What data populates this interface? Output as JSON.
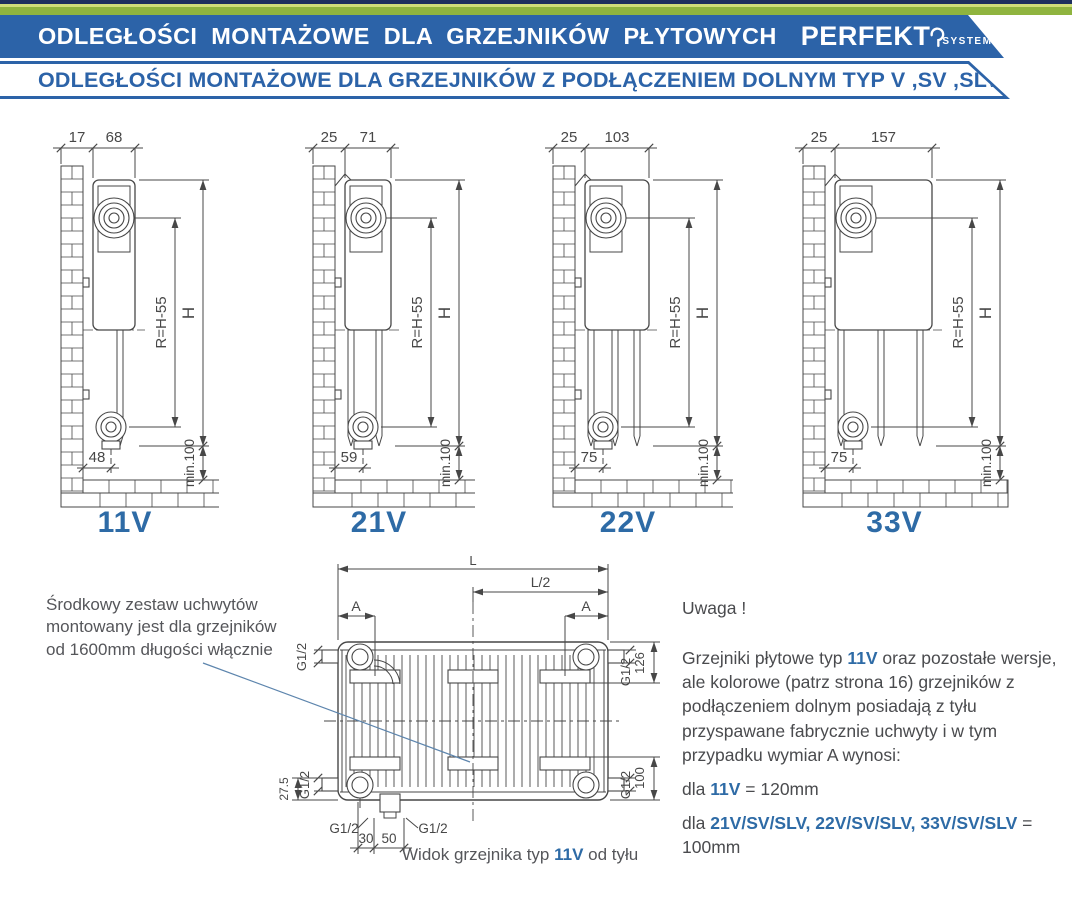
{
  "colors": {
    "ink": "#474747",
    "accent_blue": "#2e6ba6",
    "banner_blue": "#2c63a8",
    "navy": "#1d2f5e",
    "green": "#8fb43f",
    "green_light": "#cfdc7a",
    "leader": "#5d85ad",
    "text_gray": "#55565a"
  },
  "header": {
    "bar1_text": "ODLEGŁOŚCI MONTAŻOWE DLA GRZEJNIKÓW PŁYTOWYCH",
    "logo_main": "PERFEKT",
    "logo_sub": "SYSTEM",
    "bar2_text": "ODLEGŁOŚCI MONTAŻOWE DLA GRZEJNIKÓW Z PODŁĄCZENIEM DOLNYM TYP V ,SV ,SLV"
  },
  "diagrams": [
    {
      "label": "11V",
      "wall_offset": "17",
      "depth": "68",
      "bottom": "48",
      "r_dim": "R=H-55",
      "h_dim": "H",
      "min_dim": "min.100"
    },
    {
      "label": "21V",
      "wall_offset": "25",
      "depth": "71",
      "bottom": "59",
      "r_dim": "R=H-55",
      "h_dim": "H",
      "min_dim": "min.100"
    },
    {
      "label": "22V",
      "wall_offset": "25",
      "depth": "103",
      "bottom": "75",
      "r_dim": "R=H-55",
      "h_dim": "H",
      "min_dim": "min.100"
    },
    {
      "label": "33V",
      "wall_offset": "25",
      "depth": "157",
      "bottom": "75",
      "r_dim": "R=H-55",
      "h_dim": "H",
      "min_dim": "min.100"
    }
  ],
  "rear_view": {
    "dims": {
      "length": "L",
      "half_length": "L/2",
      "a": "A",
      "g": "G1/2",
      "d126": "126",
      "d100": "100",
      "d275": "27.5",
      "d30": "30",
      "d50": "50"
    },
    "caption_prefix": "Widok grzejnika typ ",
    "caption_key": "11V",
    "caption_suffix": " od tyłu"
  },
  "side_note": {
    "lines": [
      "Środkowy zestaw uchwytów",
      "montowany jest dla grzejników",
      "od 1600mm długości włącznie"
    ]
  },
  "notice": {
    "title": "Uwaga !",
    "p_before": "Grzejniki płytowe typ ",
    "p_key": "11V",
    "p_after": " oraz pozostałe wersje, ale kolorowe (patrz strona 16) grzejników z podłączeniem dolnym posiadają z tyłu przyspawane fabrycznie uchwyty i w tym przypadku wymiar A wynosi:",
    "line1_prefix": "dla ",
    "line1_key": "11V",
    "line1_suffix": " = 120mm",
    "line2_prefix": "dla ",
    "line2_key": "21V/SV/SLV, 22V/SV/SLV, 33V/SV/SLV",
    "line2_suffix": " = 100mm"
  }
}
